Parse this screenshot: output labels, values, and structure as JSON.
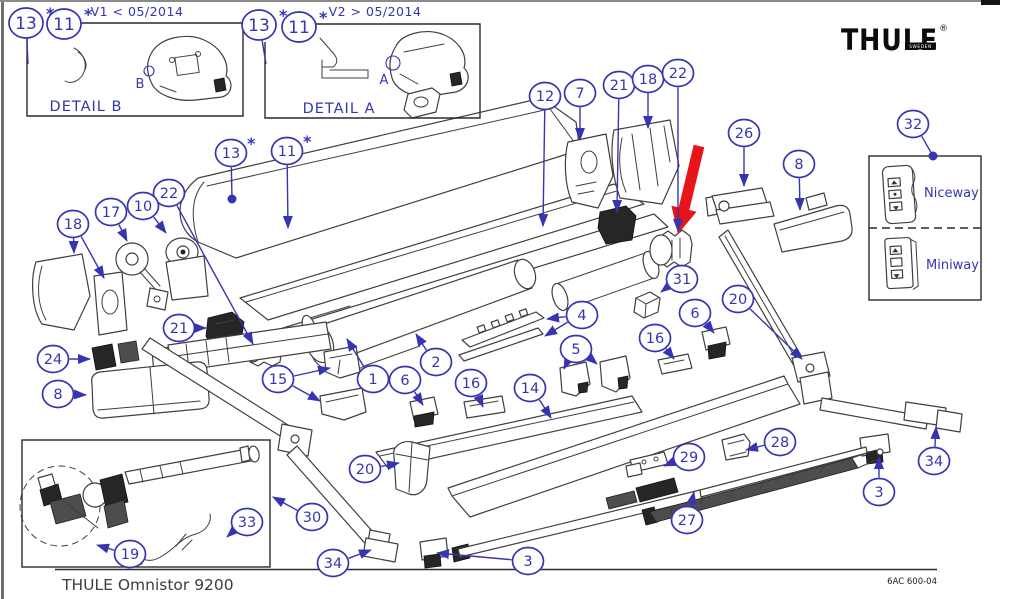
{
  "style": {
    "callout_blue": "#3535b2",
    "red": "#e8131b",
    "line_gray": "#3f3f3f",
    "dark_fill": "#262626",
    "ink": "#2a2a2a"
  },
  "config": {
    "asterisk_glyph": "*"
  },
  "logo": {
    "brand": "THULE",
    "sub": "SWEDEN",
    "reg": "®"
  },
  "insets": {
    "detail_b": {
      "version_label": "V1 < 05/2014",
      "caption": "DETAIL B",
      "ref_letter": "B"
    },
    "detail_a": {
      "version_label": "V2 > 05/2014",
      "caption": "DETAIL A",
      "ref_letter": "A"
    }
  },
  "remote_panel": {
    "callout": "32",
    "options": [
      {
        "name": "Niceway"
      },
      {
        "name": "Miniway"
      }
    ]
  },
  "footer": {
    "model": "THULE Omnistor 9200",
    "doc_number": "6AC 600-04"
  },
  "callouts": [
    {
      "label": "13",
      "x": 26,
      "y": 23,
      "size": "lg",
      "asterisk": true,
      "leaders": [
        {
          "to": [
            28,
            64
          ],
          "end": "none"
        }
      ]
    },
    {
      "label": "11",
      "x": 64,
      "y": 24,
      "size": "lg",
      "asterisk": true,
      "leaders": []
    },
    {
      "label": "13",
      "x": 259,
      "y": 25,
      "size": "lg",
      "asterisk": true,
      "leaders": [
        {
          "to": [
            266,
            64
          ],
          "end": "none"
        }
      ]
    },
    {
      "label": "11",
      "x": 299,
      "y": 27,
      "size": "lg",
      "asterisk": true,
      "leaders": []
    },
    {
      "label": "13",
      "x": 231,
      "y": 153,
      "asterisk": true,
      "leaders": [
        {
          "to": [
            232,
            199
          ],
          "end": "dot"
        }
      ]
    },
    {
      "label": "11",
      "x": 287,
      "y": 151,
      "asterisk": true,
      "leaders": [
        {
          "to": [
            288,
            228
          ],
          "end": "arrow"
        }
      ]
    },
    {
      "label": "22",
      "x": 169,
      "y": 193,
      "leaders": [
        {
          "to": [
            253,
            344
          ],
          "end": "arrow"
        }
      ]
    },
    {
      "label": "10",
      "x": 143,
      "y": 206,
      "leaders": [
        {
          "to": [
            166,
            233
          ],
          "end": "arrow"
        }
      ]
    },
    {
      "label": "17",
      "x": 111,
      "y": 212,
      "leaders": [
        {
          "to": [
            127,
            241
          ],
          "end": "arrow"
        }
      ]
    },
    {
      "label": "18",
      "x": 73,
      "y": 224,
      "leaders": [
        {
          "to": [
            74,
            253
          ],
          "end": "arrow"
        },
        {
          "to": [
            104,
            278
          ],
          "end": "arrow"
        }
      ]
    },
    {
      "label": "21",
      "x": 179,
      "y": 328,
      "leaders": [
        {
          "to": [
            206,
            328
          ],
          "end": "arrow"
        }
      ]
    },
    {
      "label": "24",
      "x": 53,
      "y": 359,
      "leaders": [
        {
          "to": [
            90,
            359
          ],
          "end": "arrow"
        }
      ]
    },
    {
      "label": "8",
      "x": 58,
      "y": 394,
      "leaders": [
        {
          "to": [
            86,
            395
          ],
          "end": "arrow"
        }
      ]
    },
    {
      "label": "15",
      "x": 278,
      "y": 379,
      "leaders": [
        {
          "to": [
            330,
            368
          ],
          "end": "arrow"
        },
        {
          "to": [
            320,
            401
          ],
          "end": "arrow"
        }
      ]
    },
    {
      "label": "1",
      "x": 373,
      "y": 379,
      "leaders": [
        {
          "to": [
            347,
            339
          ],
          "end": "arrow"
        }
      ]
    },
    {
      "label": "6",
      "x": 405,
      "y": 380,
      "leaders": [
        {
          "to": [
            423,
            405
          ],
          "end": "arrow"
        }
      ]
    },
    {
      "label": "2",
      "x": 436,
      "y": 362,
      "leaders": [
        {
          "to": [
            416,
            334
          ],
          "end": "arrow"
        }
      ]
    },
    {
      "label": "16",
      "x": 471,
      "y": 383,
      "leaders": [
        {
          "to": [
            483,
            407
          ],
          "end": "arrow"
        }
      ]
    },
    {
      "label": "14",
      "x": 530,
      "y": 388,
      "leaders": [
        {
          "to": [
            551,
            418
          ],
          "end": "arrow"
        }
      ]
    },
    {
      "label": "4",
      "x": 582,
      "y": 315,
      "leaders": [
        {
          "to": [
            547,
            319
          ],
          "end": "arrow"
        },
        {
          "to": [
            545,
            336
          ],
          "end": "arrow"
        }
      ]
    },
    {
      "label": "5",
      "x": 576,
      "y": 349,
      "leaders": [
        {
          "to": [
            564,
            369
          ],
          "end": "arrow"
        },
        {
          "to": [
            597,
            364
          ],
          "end": "arrow"
        }
      ]
    },
    {
      "label": "12",
      "x": 545,
      "y": 96,
      "leaders": [
        {
          "to": [
            543,
            226
          ],
          "end": "arrow"
        }
      ]
    },
    {
      "label": "7",
      "x": 580,
      "y": 93,
      "leaders": [
        {
          "to": [
            580,
            140
          ],
          "end": "arrow"
        }
      ]
    },
    {
      "label": "21",
      "x": 619,
      "y": 85,
      "leaders": [
        {
          "to": [
            617,
            212
          ],
          "end": "arrow"
        }
      ]
    },
    {
      "label": "18",
      "x": 648,
      "y": 79,
      "leaders": [
        {
          "to": [
            648,
            128
          ],
          "end": "arrow"
        }
      ]
    },
    {
      "label": "22",
      "x": 678,
      "y": 73,
      "leaders": [
        {
          "to": [
            678,
            231
          ],
          "end": "arrow"
        }
      ]
    },
    {
      "label": "26",
      "x": 744,
      "y": 133,
      "leaders": [
        {
          "to": [
            744,
            186
          ],
          "end": "arrow"
        }
      ]
    },
    {
      "label": "8",
      "x": 799,
      "y": 164,
      "leaders": [
        {
          "to": [
            800,
            210
          ],
          "end": "arrow"
        }
      ]
    },
    {
      "label": "31",
      "x": 682,
      "y": 279,
      "leaders": [
        {
          "to": [
            661,
            292
          ],
          "end": "arrow"
        }
      ]
    },
    {
      "label": "6",
      "x": 695,
      "y": 313,
      "leaders": [
        {
          "to": [
            714,
            333
          ],
          "end": "arrow"
        }
      ]
    },
    {
      "label": "16",
      "x": 655,
      "y": 338,
      "leaders": [
        {
          "to": [
            674,
            359
          ],
          "end": "arrow"
        }
      ]
    },
    {
      "label": "20",
      "x": 738,
      "y": 299,
      "leaders": [
        {
          "to": [
            802,
            359
          ],
          "end": "arrow"
        }
      ]
    },
    {
      "label": "20",
      "x": 365,
      "y": 469,
      "leaders": [
        {
          "to": [
            399,
            463
          ],
          "end": "arrow"
        }
      ]
    },
    {
      "label": "30",
      "x": 312,
      "y": 517,
      "leaders": [
        {
          "to": [
            273,
            497
          ],
          "end": "arrow"
        }
      ]
    },
    {
      "label": "19",
      "x": 130,
      "y": 554,
      "leaders": [
        {
          "to": [
            97,
            545
          ],
          "end": "arrow"
        }
      ]
    },
    {
      "label": "33",
      "x": 247,
      "y": 522,
      "leaders": [
        {
          "to": [
            227,
            537
          ],
          "end": "arrow"
        }
      ]
    },
    {
      "label": "34",
      "x": 333,
      "y": 563,
      "leaders": [
        {
          "to": [
            371,
            550
          ],
          "end": "arrow"
        }
      ]
    },
    {
      "label": "3",
      "x": 528,
      "y": 561,
      "leaders": [
        {
          "to": [
            437,
            553
          ],
          "end": "arrow"
        }
      ]
    },
    {
      "label": "29",
      "x": 689,
      "y": 457,
      "leaders": [
        {
          "to": [
            664,
            466
          ],
          "end": "arrow"
        }
      ]
    },
    {
      "label": "28",
      "x": 780,
      "y": 442,
      "leaders": [
        {
          "to": [
            746,
            450
          ],
          "end": "arrow"
        }
      ]
    },
    {
      "label": "27",
      "x": 687,
      "y": 520,
      "leaders": [
        {
          "to": [
            694,
            492
          ],
          "end": "arrow"
        }
      ]
    },
    {
      "label": "3",
      "x": 879,
      "y": 492,
      "leaders": [
        {
          "to": [
            879,
            457
          ],
          "end": "arrow"
        }
      ]
    },
    {
      "label": "34",
      "x": 934,
      "y": 461,
      "leaders": [
        {
          "to": [
            936,
            427
          ],
          "end": "arrow"
        }
      ]
    },
    {
      "label": "32",
      "x": 913,
      "y": 124,
      "leaders": [
        {
          "to": [
            933,
            156
          ],
          "end": "dot"
        }
      ]
    }
  ]
}
